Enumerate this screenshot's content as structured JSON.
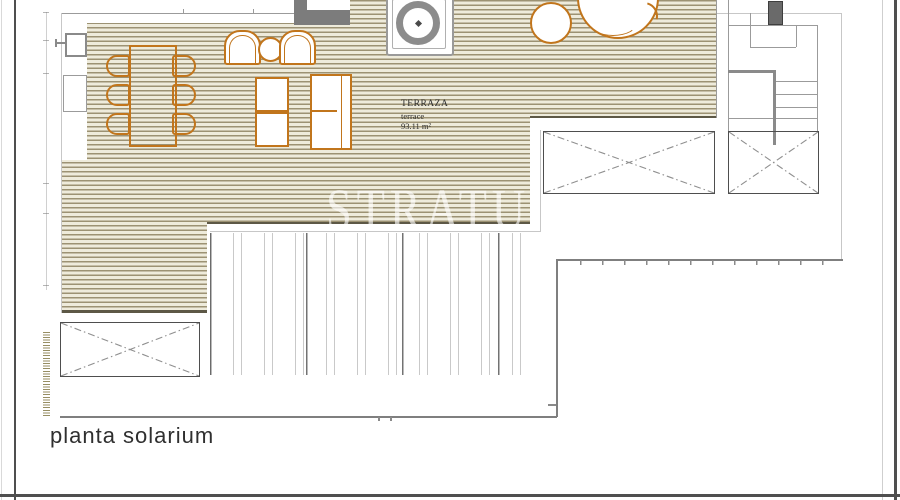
{
  "title_block": {
    "plan_title": "planta solarium"
  },
  "room_label": {
    "name": "TERRAZA",
    "name_en": "terrace",
    "area": "93.11 m²"
  },
  "watermark": {
    "text": "STRATU"
  },
  "colors": {
    "deck_stripe": "#9c9273",
    "deck_bg": "#eeebdb",
    "furniture_orange": "#c1751c",
    "wall_gray": "#7c7c7c",
    "line_gray": "#9b9b9b",
    "boundary_gray": "#7f7f7f",
    "edge_dark": "#5d5846",
    "chimney_fill": "#6a6a6a",
    "hatch_olive": "#978e63"
  },
  "symbols": {
    "bbq-grill": "circle-ring-in-square",
    "dining-table": "rect-outline",
    "dining-chair": "rounded-square",
    "armchair": "double-arch",
    "side-table": "small-circle",
    "sun-lounger": "paned-rect",
    "deck-table": "square-outline",
    "plant": "circle-with-swirl",
    "skylight": "x-crossed-rect",
    "stairs": "tread-lines",
    "chimney": "filled-dark-rect",
    "pergola-slats": "vertical-slats",
    "door": "thin-rect",
    "wall-switch": "boxed-switch"
  }
}
